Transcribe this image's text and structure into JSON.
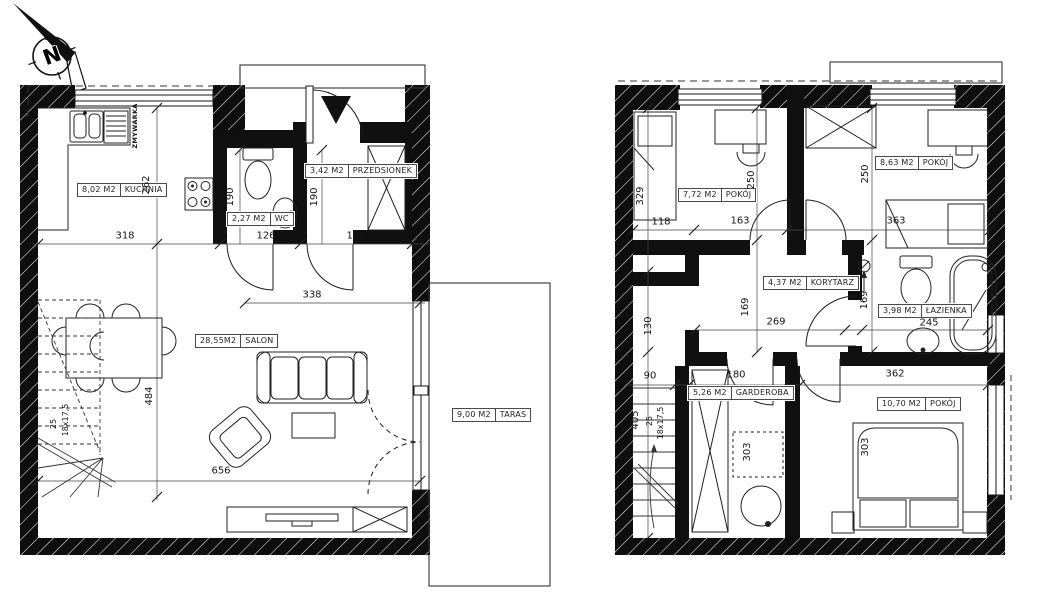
{
  "compass": {
    "letter": "N"
  },
  "plans": [
    {
      "name": "ground-floor",
      "rooms": [
        {
          "area": "8,02 M2",
          "label": "KUCHNIA"
        },
        {
          "area": "2,27 M2",
          "label": "WC"
        },
        {
          "area": "3,42 M2",
          "label": "PRZEDSIONEK"
        },
        {
          "area": "28,55M2",
          "label": "SALON"
        },
        {
          "area": "9,00 M2",
          "label": "TARAS"
        }
      ],
      "dims": [
        "318",
        "126",
        "188",
        "262",
        "190",
        "190",
        "338",
        "484",
        "656"
      ],
      "stairs": {
        "steps": "25",
        "tread": "18x17,5"
      },
      "appliance": "ZMYWARKA"
    },
    {
      "name": "upper-floor",
      "rooms": [
        {
          "area": "7,72 M2",
          "label": "POKÓJ"
        },
        {
          "area": "8,63 M2",
          "label": "POKÓJ"
        },
        {
          "area": "4,37 M2",
          "label": "KORYTARZ"
        },
        {
          "area": "3,98 M2",
          "label": "ŁAZIENKA"
        },
        {
          "area": "5,26 M2",
          "label": "GARDEROBA"
        },
        {
          "area": "10,70 M2",
          "label": "POKÓJ"
        }
      ],
      "dims": [
        "118",
        "163",
        "363",
        "329",
        "250",
        "250",
        "130",
        "169",
        "269",
        "169",
        "245",
        "90",
        "180",
        "362",
        "405",
        "303",
        "303"
      ],
      "stairs": {
        "steps": "25",
        "tread": "18x17,5"
      }
    }
  ]
}
